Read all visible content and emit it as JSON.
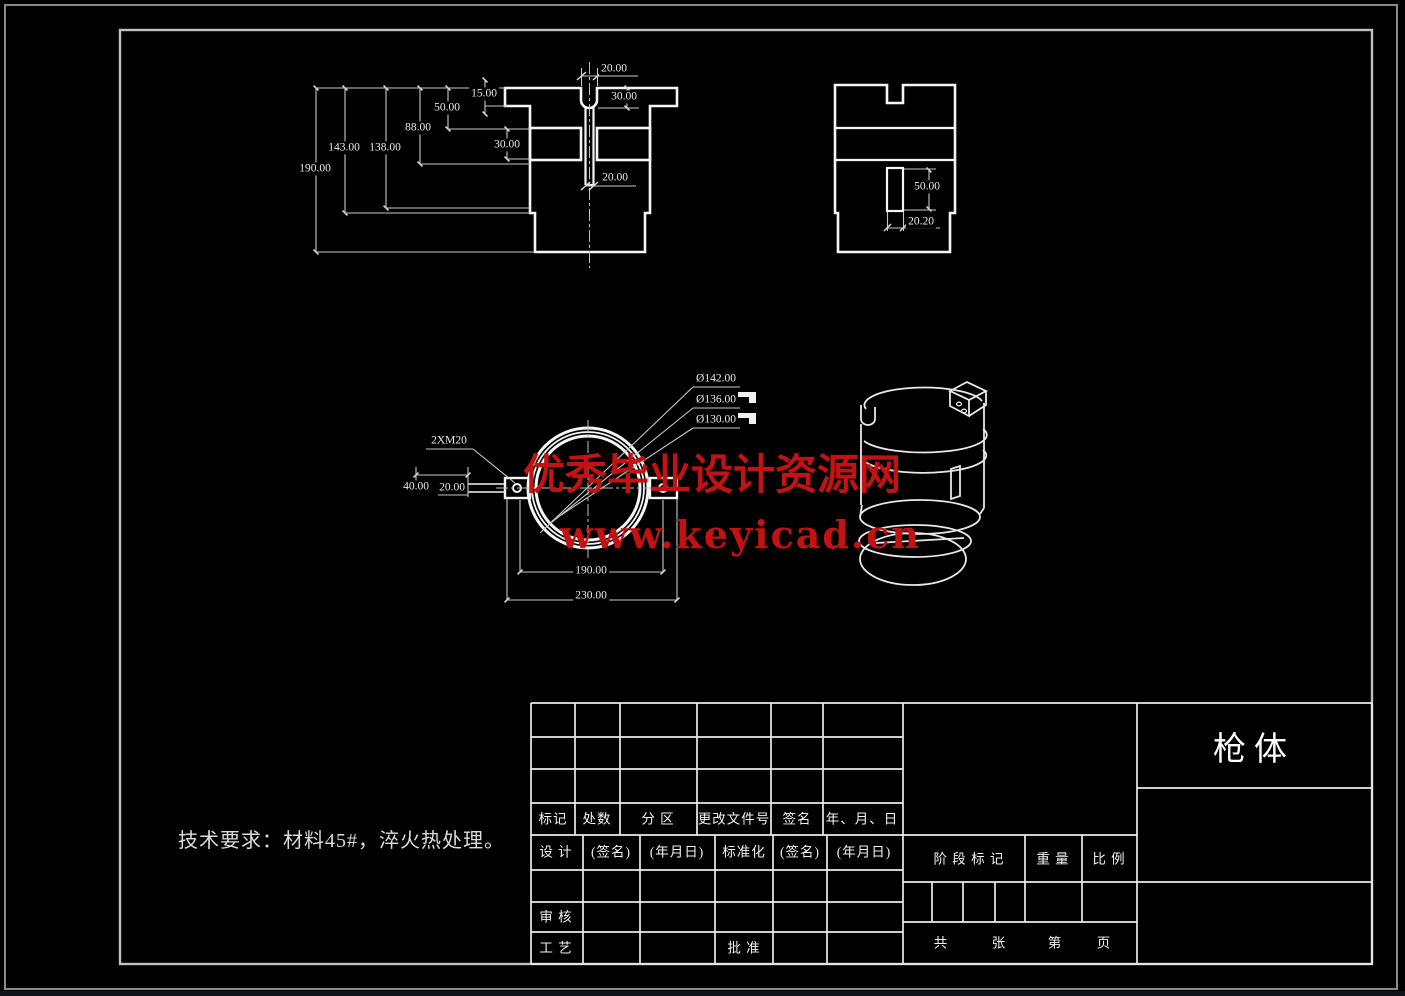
{
  "views": {
    "front": {
      "dims": {
        "h190": "190.00",
        "h143": "143.00",
        "h138": "138.00",
        "h88": "88.00",
        "h50": "50.00",
        "h15": "15.00",
        "top20": "20.00",
        "udepth30": "30.00",
        "groove30": "30.00",
        "slot20": "20.00"
      }
    },
    "side": {
      "dims": {
        "v50": "50.00",
        "w2020": "20.20"
      }
    },
    "section": {
      "dims": {
        "dia142": "Ø142.00",
        "dia136": "Ø136.00",
        "dia130": "Ø130.00",
        "thread": "2XM20",
        "w40": "40.00",
        "w20": "20.00",
        "w190": "190.00",
        "w230": "230.00"
      }
    }
  },
  "notes": {
    "tech": "技术要求：材料45#，淬火热处理。"
  },
  "watermark": {
    "line1": "优秀毕业设计资源网",
    "line2": "www.keyicad.cn",
    "color": "#c31212"
  },
  "title_block": {
    "part_name": "枪体",
    "header_row": {
      "mark": "标记",
      "count": "处数",
      "zone": "分 区",
      "doc_no": "更改文件号",
      "sign": "签名",
      "date": "年、月、日"
    },
    "design_row": {
      "design": "设 计",
      "sign": "(签名)",
      "date": "(年月日)",
      "standard": "标准化",
      "sign2": "(签名)",
      "date2": "(年月日)"
    },
    "audit": "审 核",
    "craft": "工 艺",
    "approve": "批 准",
    "stage_mark": "阶 段 标 记",
    "weight": "重 量",
    "scale": "比 例",
    "pages": {
      "total": "共",
      "sheet": "张",
      "no": "第",
      "page": "页"
    }
  },
  "colors": {
    "line": "#f5f5f5",
    "dim_line": "#c8c8c8",
    "frame_outer": "#8a8a8a",
    "frame_inner": "#c0c0c0"
  }
}
